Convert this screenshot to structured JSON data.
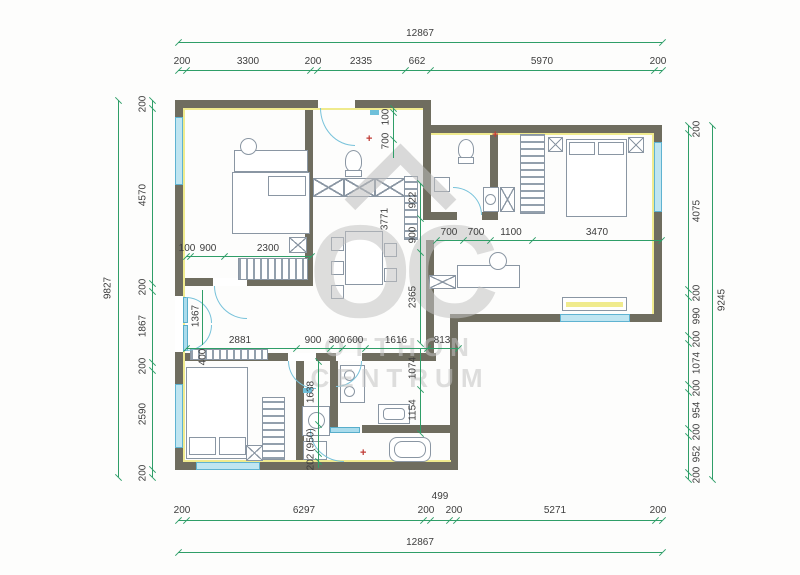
{
  "watermark": {
    "logo": "OC",
    "line1": "OTTHON",
    "line2": "CENTRUM"
  },
  "colors": {
    "dimension_green": "#2f9e68",
    "wall_gray": "#6f6d5f",
    "insulation_yellow": "#f0eb8e",
    "window_blue": "#bfe5f1",
    "watermark_gray": "#c3c3c3",
    "fixture_red": "#c03a34"
  },
  "dims": {
    "top": {
      "overall": "12867",
      "segments": [
        "200",
        "3300",
        "200",
        "2335",
        "662",
        "5970",
        "200"
      ]
    },
    "bottom": {
      "overall": "12867",
      "segments": [
        "200",
        "6297",
        "200",
        "499",
        "200",
        "5271",
        "200"
      ]
    },
    "left": {
      "overall": "9827",
      "segments": [
        "200",
        "4570",
        "200",
        "1867",
        "200",
        "2590",
        "200"
      ]
    },
    "right": {
      "overall": "9245",
      "segments": [
        "200",
        "4075",
        "200",
        "990",
        "200",
        "1074",
        "200",
        "954",
        "200",
        "952",
        "200"
      ]
    },
    "interior": {
      "bedroom1_chain": [
        "100",
        "900",
        "2300"
      ],
      "bedroom1_height": "1367",
      "bed_length": "3771",
      "niche": "400",
      "corridor_chain": [
        "922",
        "900",
        "2365"
      ],
      "entry_chain": [
        "100",
        "700"
      ],
      "bath_chain": [
        "700",
        "700",
        "1100",
        "3470"
      ],
      "middle_chain": [
        "2881",
        "900",
        "300",
        "600",
        "1616",
        "813"
      ],
      "kitchen_chain": [
        "1074",
        "1154"
      ],
      "bath2_chain": [
        "1638",
        "(950)",
        "202"
      ]
    }
  }
}
